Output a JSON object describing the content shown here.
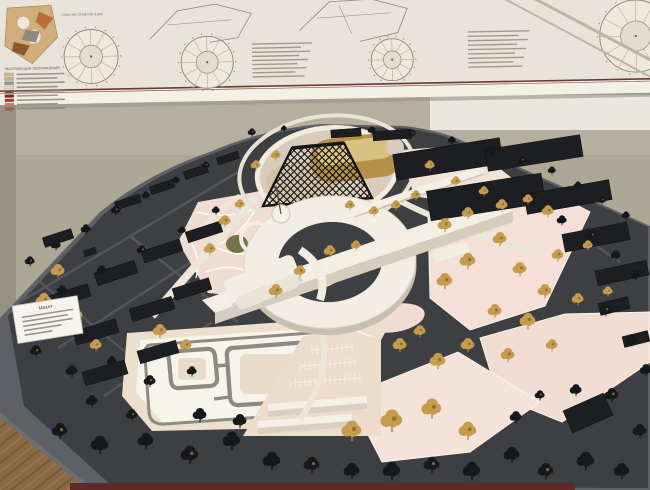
{
  "scene": {
    "type": "photograph",
    "subject": "architectural-site-model-on-round-table-with-plan-poster"
  },
  "poster": {
    "legend_heading": "ЭКСПЛИКАЦИЯ ОБОЗНАЧЕНИЙ",
    "plan_caption": "ПЛАН НА ОТМЕТКЕ 0,000",
    "legend_chips": [
      "#d8b48c",
      "#c4ae91",
      "#9b9184",
      "#e3d9c6",
      "#7a4e35",
      "#6e3128",
      "#a63a2e",
      "#c47b6a",
      "#8c6b52"
    ],
    "legend_line_width": 48,
    "list_blocks": [
      {
        "x": 252,
        "y": 42,
        "rows": 9,
        "width": 60,
        "step": 4.1
      },
      {
        "x": 468,
        "y": 34,
        "rows": 9,
        "width": 62,
        "step": 4.4
      }
    ],
    "circle_plans": [
      {
        "cx": 91,
        "cy": 52,
        "r": 27
      },
      {
        "cx": 207,
        "cy": 60,
        "r": 26
      },
      {
        "cx": 392,
        "cy": 61,
        "r": 21
      },
      {
        "cx": 636,
        "cy": 42,
        "r": 36
      }
    ]
  },
  "label_card": {
    "title": "Макет",
    "line_widths": [
      52,
      46,
      50,
      38,
      28
    ]
  },
  "colors": {
    "wall": "#ada795",
    "poster_bg": "#e8e4d9",
    "poster_lip": "#f3f0e7",
    "maroon_line": "#6e3734",
    "floor_wood": "#8a6a45",
    "base_top": "#3d3f43",
    "base_side": "#5e6066",
    "street": "#54565b",
    "plate_cream": "#ecdfce",
    "plate_pink": "#f4e0d6",
    "white_building": "#f2eee3",
    "white_shadow": "#c9c2b0",
    "amber_building": "#b59147",
    "amber_top": "#d9c184",
    "plaza_floor": "#d8cdbc",
    "gold_ground": "#c6ae72",
    "lawn_green": "#717549",
    "lattice_black": "#141414",
    "context_black": "#1d1e21",
    "tree_gold": "#c59b4d",
    "tree_dark": "#17181b",
    "maroon_strip": "#5e2b2a"
  },
  "model": {
    "gold_trees": [
      [
        445,
        226,
        7
      ],
      [
        468,
        214,
        6
      ],
      [
        502,
        206,
        6
      ],
      [
        528,
        200,
        5
      ],
      [
        548,
        212,
        6
      ],
      [
        500,
        240,
        7
      ],
      [
        468,
        262,
        8
      ],
      [
        445,
        282,
        8
      ],
      [
        520,
        270,
        7
      ],
      [
        558,
        256,
        6
      ],
      [
        588,
        246,
        5
      ],
      [
        545,
        292,
        7
      ],
      [
        578,
        300,
        6
      ],
      [
        608,
        292,
        5
      ],
      [
        495,
        312,
        7
      ],
      [
        528,
        322,
        8
      ],
      [
        468,
        346,
        7
      ],
      [
        438,
        362,
        8
      ],
      [
        508,
        356,
        7
      ],
      [
        552,
        346,
        6
      ],
      [
        420,
        332,
        6
      ],
      [
        400,
        346,
        7
      ],
      [
        352,
        432,
        10
      ],
      [
        392,
        422,
        11
      ],
      [
        432,
        410,
        10
      ],
      [
        468,
        432,
        9
      ],
      [
        330,
        252,
        6
      ],
      [
        356,
        246,
        5
      ],
      [
        300,
        272,
        6
      ],
      [
        276,
        292,
        7
      ],
      [
        58,
        272,
        7
      ],
      [
        44,
        302,
        8
      ],
      [
        76,
        316,
        7
      ],
      [
        30,
        332,
        8
      ],
      [
        96,
        346,
        6
      ],
      [
        160,
        332,
        7
      ],
      [
        186,
        346,
        6
      ],
      [
        256,
        166,
        5
      ],
      [
        276,
        156,
        5
      ],
      [
        350,
        206,
        5
      ],
      [
        374,
        212,
        5
      ],
      [
        396,
        206,
        5
      ],
      [
        416,
        196,
        5
      ],
      [
        430,
        166,
        5
      ],
      [
        456,
        182,
        5
      ],
      [
        484,
        192,
        5
      ],
      [
        240,
        205,
        5
      ],
      [
        225,
        222,
        6
      ],
      [
        210,
        250,
        6
      ]
    ],
    "dark_trees": [
      [
        30,
        262,
        5
      ],
      [
        56,
        246,
        5
      ],
      [
        86,
        230,
        5
      ],
      [
        116,
        211,
        5
      ],
      [
        146,
        196,
        4
      ],
      [
        176,
        181,
        4
      ],
      [
        206,
        166,
        4
      ],
      [
        62,
        291,
        5
      ],
      [
        102,
        271,
        5
      ],
      [
        142,
        251,
        5
      ],
      [
        182,
        231,
        4
      ],
      [
        216,
        211,
        4
      ],
      [
        36,
        352,
        6
      ],
      [
        72,
        372,
        6
      ],
      [
        112,
        362,
        5
      ],
      [
        150,
        382,
        6
      ],
      [
        192,
        372,
        5
      ],
      [
        92,
        402,
        6
      ],
      [
        132,
        416,
        6
      ],
      [
        200,
        416,
        7
      ],
      [
        240,
        422,
        7
      ],
      [
        60,
        432,
        8
      ],
      [
        100,
        446,
        9
      ],
      [
        146,
        442,
        8
      ],
      [
        190,
        456,
        9
      ],
      [
        232,
        442,
        9
      ],
      [
        272,
        462,
        9
      ],
      [
        312,
        466,
        8
      ],
      [
        352,
        472,
        8
      ],
      [
        392,
        472,
        9
      ],
      [
        432,
        466,
        8
      ],
      [
        472,
        472,
        9
      ],
      [
        512,
        456,
        8
      ],
      [
        546,
        472,
        8
      ],
      [
        586,
        462,
        9
      ],
      [
        622,
        472,
        8
      ],
      [
        252,
        133,
        4
      ],
      [
        284,
        129,
        3
      ],
      [
        372,
        131,
        4
      ],
      [
        412,
        134,
        4
      ],
      [
        452,
        141,
        4
      ],
      [
        492,
        151,
        4
      ],
      [
        522,
        161,
        4
      ],
      [
        552,
        171,
        4
      ],
      [
        578,
        186,
        4
      ],
      [
        602,
        201,
        4
      ],
      [
        626,
        216,
        4
      ],
      [
        562,
        221,
        5
      ],
      [
        592,
        236,
        5
      ],
      [
        616,
        256,
        5
      ],
      [
        636,
        276,
        5
      ],
      [
        606,
        311,
        6
      ],
      [
        632,
        341,
        6
      ],
      [
        646,
        371,
        6
      ],
      [
        612,
        396,
        7
      ],
      [
        640,
        432,
        7
      ],
      [
        576,
        391,
        6
      ],
      [
        540,
        396,
        5
      ],
      [
        516,
        418,
        6
      ]
    ],
    "context_buildings": [
      [
        70,
        296,
        40,
        13,
        -18
      ],
      [
        116,
        273,
        42,
        13,
        -18
      ],
      [
        162,
        251,
        40,
        12,
        -18
      ],
      [
        204,
        232,
        36,
        11,
        -18
      ],
      [
        96,
        332,
        44,
        14,
        -17
      ],
      [
        152,
        309,
        44,
        13,
        -17
      ],
      [
        192,
        289,
        38,
        12,
        -17
      ],
      [
        105,
        373,
        44,
        14,
        -16
      ],
      [
        158,
        352,
        40,
        13,
        -16
      ],
      [
        128,
        202,
        26,
        8,
        -18
      ],
      [
        162,
        187,
        24,
        8,
        -18
      ],
      [
        196,
        172,
        24,
        8,
        -18
      ],
      [
        228,
        158,
        22,
        7,
        -18
      ],
      [
        346,
        133,
        30,
        8,
        -4
      ],
      [
        392,
        135,
        38,
        9,
        -4
      ],
      [
        448,
        159,
        108,
        26,
        -9
      ],
      [
        486,
        197,
        116,
        30,
        -9
      ],
      [
        534,
        153,
        96,
        22,
        -9
      ],
      [
        568,
        197,
        86,
        20,
        -10
      ],
      [
        596,
        237,
        66,
        18,
        -11
      ],
      [
        622,
        273,
        52,
        15,
        -12
      ],
      [
        588,
        413,
        44,
        24,
        -24
      ],
      [
        614,
        306,
        30,
        12,
        -14
      ],
      [
        636,
        339,
        26,
        11,
        -14
      ],
      [
        58,
        238,
        30,
        10,
        -18
      ],
      [
        90,
        252,
        12,
        6,
        -18
      ]
    ],
    "parking_rows": [
      {
        "x": 312,
        "y": 350,
        "count": 8,
        "step": 5
      },
      {
        "x": 300,
        "y": 366,
        "count": 11,
        "step": 5
      },
      {
        "x": 290,
        "y": 383,
        "count": 14,
        "step": 5
      }
    ]
  }
}
